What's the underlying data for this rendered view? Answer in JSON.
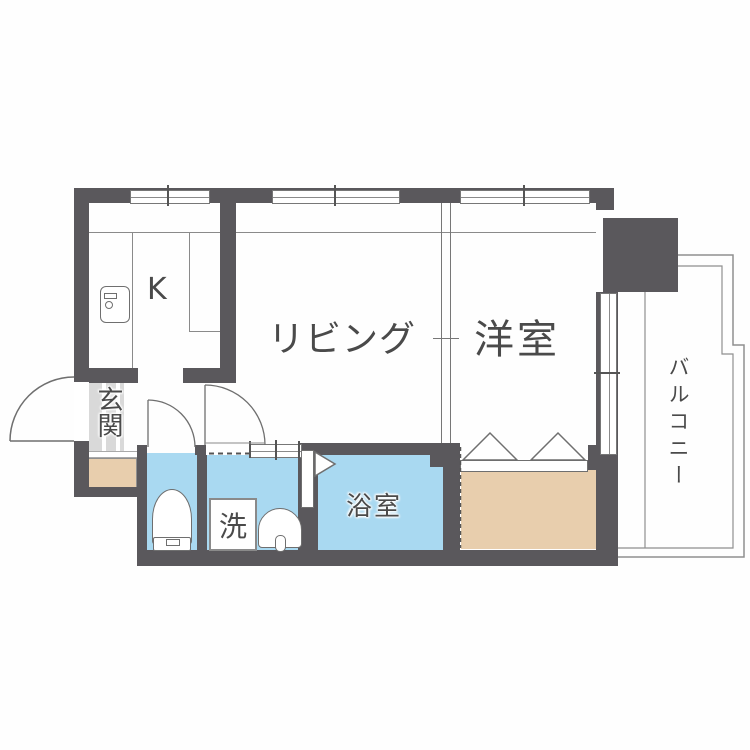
{
  "title": "apartment-floor-plan",
  "colors": {
    "wall": "#5a585c",
    "water": "#a9d9f1",
    "storage": "#e8cead",
    "tile": "#d9d9d9",
    "line": "#8a8a8a",
    "ink": "#4a4a4a"
  },
  "labels": {
    "kitchen": "K",
    "living": "リビング",
    "western_room": "洋室",
    "bathroom": "浴室",
    "entrance": "玄関",
    "balcony": "バルコニー",
    "laundry": "洗"
  }
}
